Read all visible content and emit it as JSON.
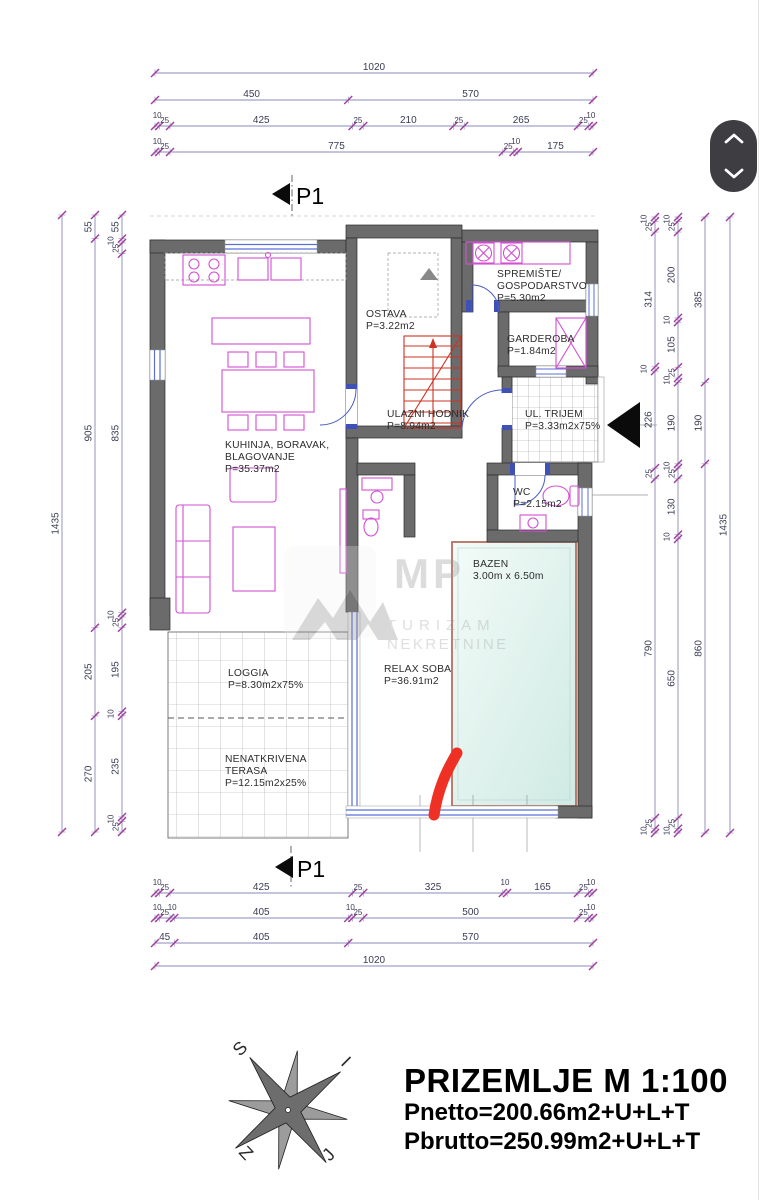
{
  "title_block": {
    "title": "PRIZEMLJE M 1:100",
    "pnetto": "Pnetto=200.66m2+U+L+T",
    "pbrutto": "Pbrutto=250.99m2+U+L+T"
  },
  "section_markers": {
    "top": "P1",
    "bottom": "P1"
  },
  "room_labels": [
    {
      "id": "ostava",
      "lines": [
        "OSTAVA",
        "P=3.22m2"
      ]
    },
    {
      "id": "spremiste",
      "lines": [
        "SPREMIŠTE/",
        "GOSPODARSTVO",
        "P=5.30m2"
      ]
    },
    {
      "id": "garderoba",
      "lines": [
        "GARDEROBA",
        "P=1.84m2"
      ]
    },
    {
      "id": "ulazni-hodnik",
      "lines": [
        "ULAZNI HODNIK",
        "P=8.94m2"
      ]
    },
    {
      "id": "ul-trijem",
      "lines": [
        "UL. TRIJEM",
        "P=3.33m2x75%"
      ]
    },
    {
      "id": "kuhinja",
      "lines": [
        "KUHINJA, BORAVAK,",
        "BLAGOVANJE",
        "P=35.37m2"
      ]
    },
    {
      "id": "wc",
      "lines": [
        "WC",
        "P=2.15m2"
      ]
    },
    {
      "id": "bazen",
      "lines": [
        "BAZEN",
        "3.00m x 6.50m"
      ]
    },
    {
      "id": "relax",
      "lines": [
        "RELAX SOBA",
        "P=36.91m2"
      ]
    },
    {
      "id": "loggia",
      "lines": [
        "LOGGIA",
        "P=8.30m2x75%"
      ]
    },
    {
      "id": "terasa",
      "lines": [
        "NENATKRIVENA",
        "TERASA",
        "P=12.15m2x25%"
      ]
    }
  ],
  "dim_lines": {
    "top": [
      [
        1020
      ],
      [
        450,
        570
      ],
      [
        10,
        25,
        425,
        25,
        210,
        25,
        265,
        25,
        10
      ],
      [
        10,
        25,
        775,
        25,
        10,
        175
      ]
    ],
    "bottom": [
      [
        10,
        25,
        425,
        25,
        325,
        10,
        165,
        25,
        10
      ],
      [
        10,
        25,
        10,
        405,
        10,
        25,
        500,
        25,
        10
      ],
      [
        45,
        405,
        570
      ],
      [
        1020
      ]
    ],
    "left": [
      [
        1435
      ],
      [
        55,
        905,
        205,
        270
      ],
      [
        55,
        10,
        25,
        835,
        10,
        25,
        195,
        10,
        235,
        10,
        25
      ]
    ],
    "right": [
      [
        10,
        25,
        314,
        10,
        226,
        25,
        790,
        25,
        10
      ],
      [
        10,
        25,
        200,
        10,
        105,
        25,
        10,
        190,
        10,
        25,
        130,
        10,
        650,
        25,
        10
      ],
      [
        385,
        190,
        860
      ],
      [
        1435
      ]
    ]
  },
  "watermark": {
    "logo": "MP",
    "line1": "TURIZAM",
    "line2": "NEKRETNINE"
  },
  "compass": {
    "top_left": "S",
    "top_right": "I",
    "bottom_right": "J",
    "bottom_left": "Z"
  },
  "colors": {
    "wall_gray": "#6b6b6b",
    "furniture_magenta": "#d24fd2",
    "window_blue": "#5b6fd6",
    "door_jamb_blue": "#3f51b5",
    "stair_red": "#cc3322",
    "annotation_red": "#ee3124",
    "pool_fill": "#ddf2ec",
    "pool_border": "#b5705f",
    "dim_tick_purple": "#a03aa0",
    "dim_line": "#8a8ab8",
    "scroll_widget_bg": "#3e3d42"
  }
}
